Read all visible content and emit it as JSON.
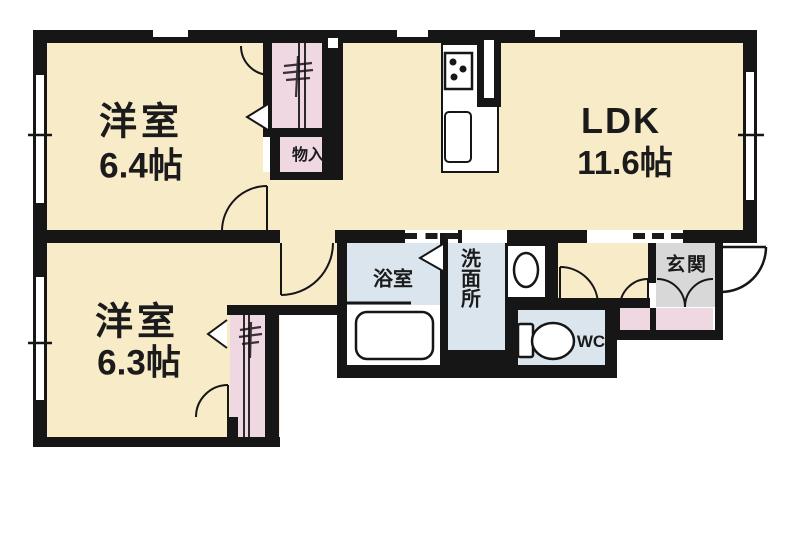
{
  "plan_title": "apartment-floorplan-2LDK",
  "rooms": {
    "west1": {
      "label": "洋室",
      "area": "6.4帖"
    },
    "ldk": {
      "label": "LDK",
      "area": "11.6帖"
    },
    "west2": {
      "label": "洋室",
      "area": "6.3帖"
    },
    "bath": {
      "label": "浴室"
    },
    "washroom": {
      "label": "洗面所"
    },
    "wc": {
      "label": "WC"
    },
    "entrance": {
      "label": "玄関"
    },
    "storage": {
      "label": "物入"
    }
  },
  "colors": {
    "floor_cream": "#F8EBC8",
    "closet_pink": "#EFD8E2",
    "wet_blue": "#DAE5ED",
    "entry_gray": "#D8D8D8",
    "wall": "#161616",
    "background": "#FFFFFF"
  },
  "icons": [
    "stove-icon",
    "sink-icon",
    "bathtub-icon",
    "washbasin-icon",
    "toilet-icon",
    "hanger-rod-icon",
    "folding-door-icon",
    "door-swing-arc",
    "window-tick"
  ]
}
